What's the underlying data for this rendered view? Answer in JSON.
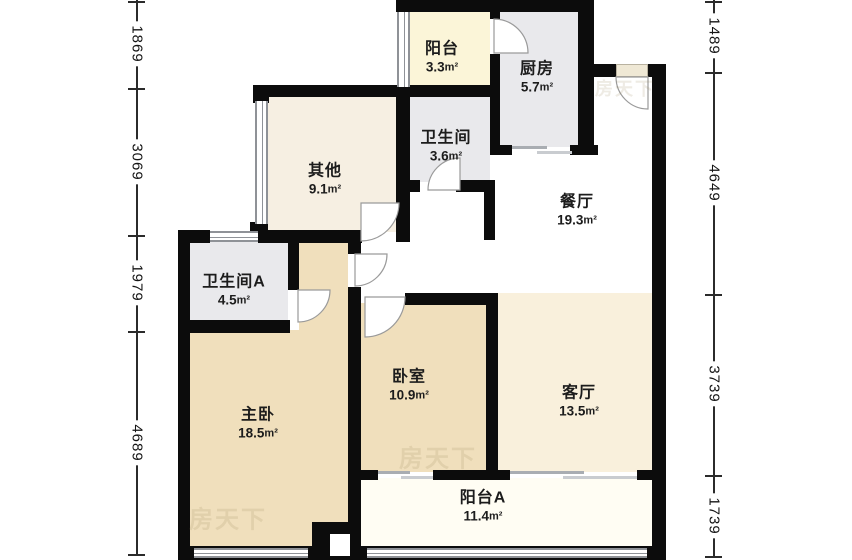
{
  "unit": "m²",
  "rooms": [
    {
      "name": "阳台",
      "area": "3.3"
    },
    {
      "name": "厨房",
      "area": "5.7"
    },
    {
      "name": "卫生间",
      "area": "3.6"
    },
    {
      "name": "其他",
      "area": "9.1"
    },
    {
      "name": "餐厅",
      "area": "19.3"
    },
    {
      "name": "卫生间A",
      "area": "4.5"
    },
    {
      "name": "主卧",
      "area": "18.5"
    },
    {
      "name": "卧室",
      "area": "10.9"
    },
    {
      "name": "客厅",
      "area": "13.5"
    },
    {
      "name": "阳台A",
      "area": "11.4"
    }
  ],
  "dims": {
    "left": [
      "1869",
      "3069",
      "1979",
      "4689"
    ],
    "right": [
      "1489",
      "4649",
      "3739",
      "1739"
    ]
  },
  "watermark": {
    "text": "房天下"
  },
  "colors": {
    "wall": "#0c0c0c",
    "balcony_north_floor": "#fbf5d8",
    "kitchen_floor": "#e9e9ec",
    "bathroom_floor": "#e9e9ec",
    "other_floor": "#f6efe2",
    "bedroom_floor": "#f0dfbc",
    "living_floor": "#f9f0dc",
    "balcony_a_floor": "#fffdf3",
    "dining_floor": "#ffffff"
  }
}
